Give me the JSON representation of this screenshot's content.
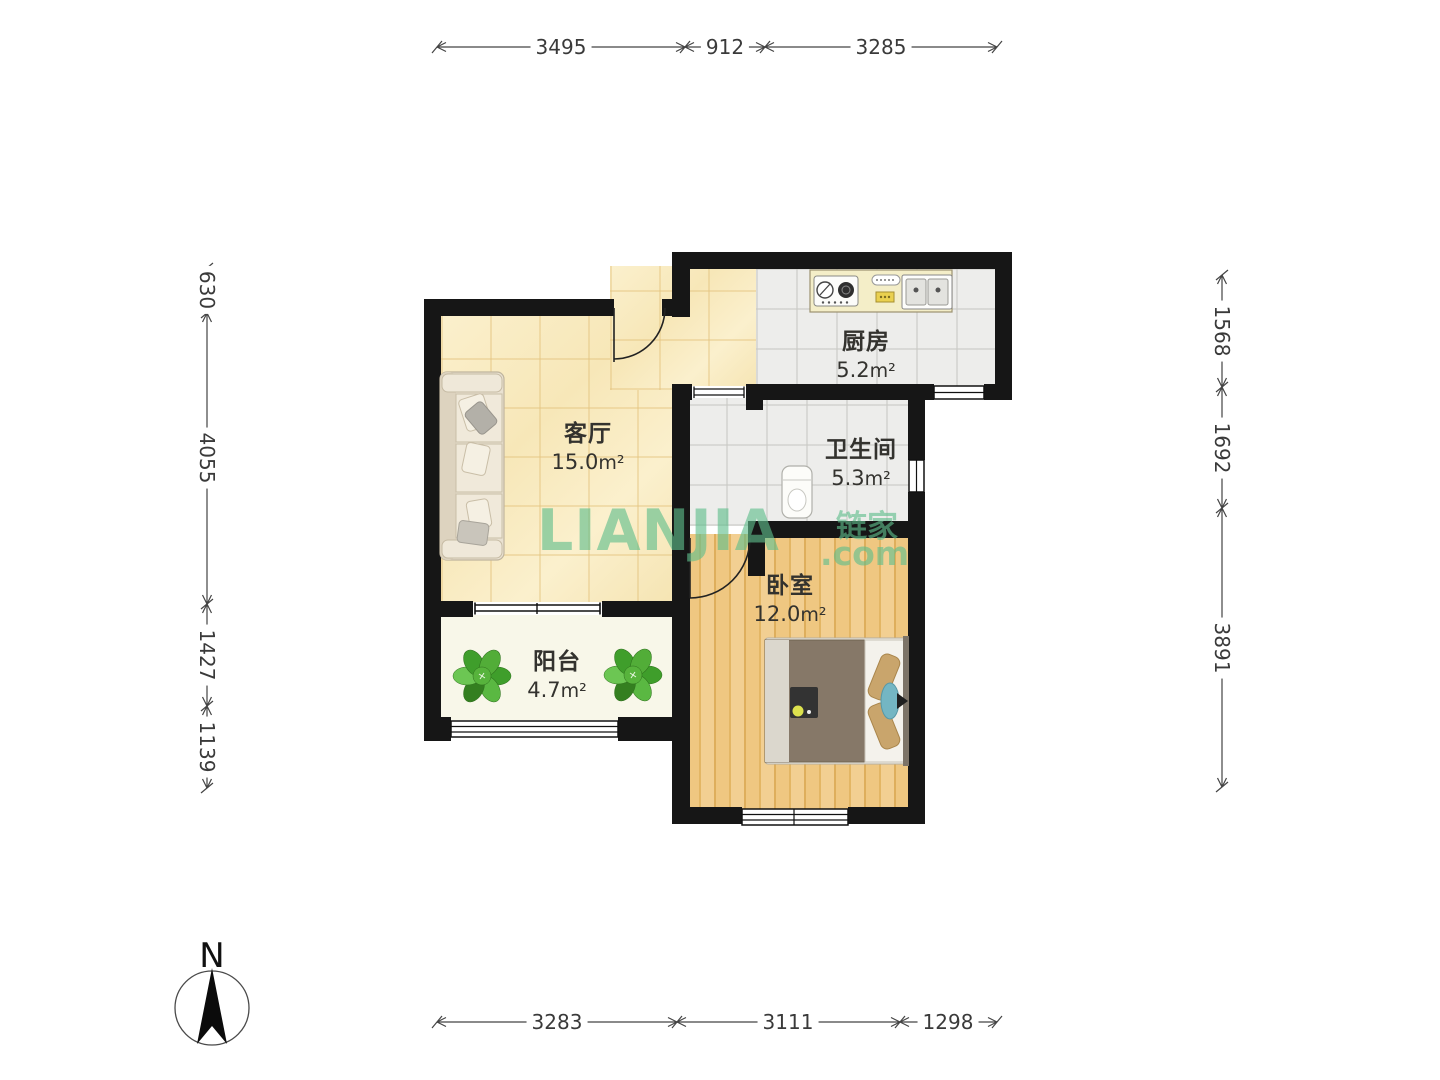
{
  "compass": {
    "label": "N"
  },
  "watermark": {
    "brand": "LIANJIA",
    "suffix": ".com",
    "brand_cn": "链家",
    "color": "#5fbe8c"
  },
  "units": {
    "area": "m²"
  },
  "rooms": {
    "living": {
      "name": "客厅",
      "area": "15.0"
    },
    "kitchen": {
      "name": "厨房",
      "area": "5.2"
    },
    "bathroom": {
      "name": "卫生间",
      "area": "5.3"
    },
    "bedroom": {
      "name": "卧室",
      "area": "12.0"
    },
    "balcony": {
      "name": "阳台",
      "area": "4.7"
    }
  },
  "dimensions_mm": {
    "top": [
      "3495",
      "912",
      "3285"
    ],
    "bottom": [
      "3283",
      "3111",
      "1298"
    ],
    "left": [
      "630",
      "4055",
      "1427",
      "1139"
    ],
    "right": [
      "1568",
      "1692",
      "3891"
    ]
  },
  "colors": {
    "wall": "#161616",
    "floor-living": "#faeec9",
    "floor-tile": "#ededeb",
    "floor-wood": "#ecc27b",
    "floor-balcony": "#f8f7e9",
    "watermark": "#5fbe8c"
  }
}
